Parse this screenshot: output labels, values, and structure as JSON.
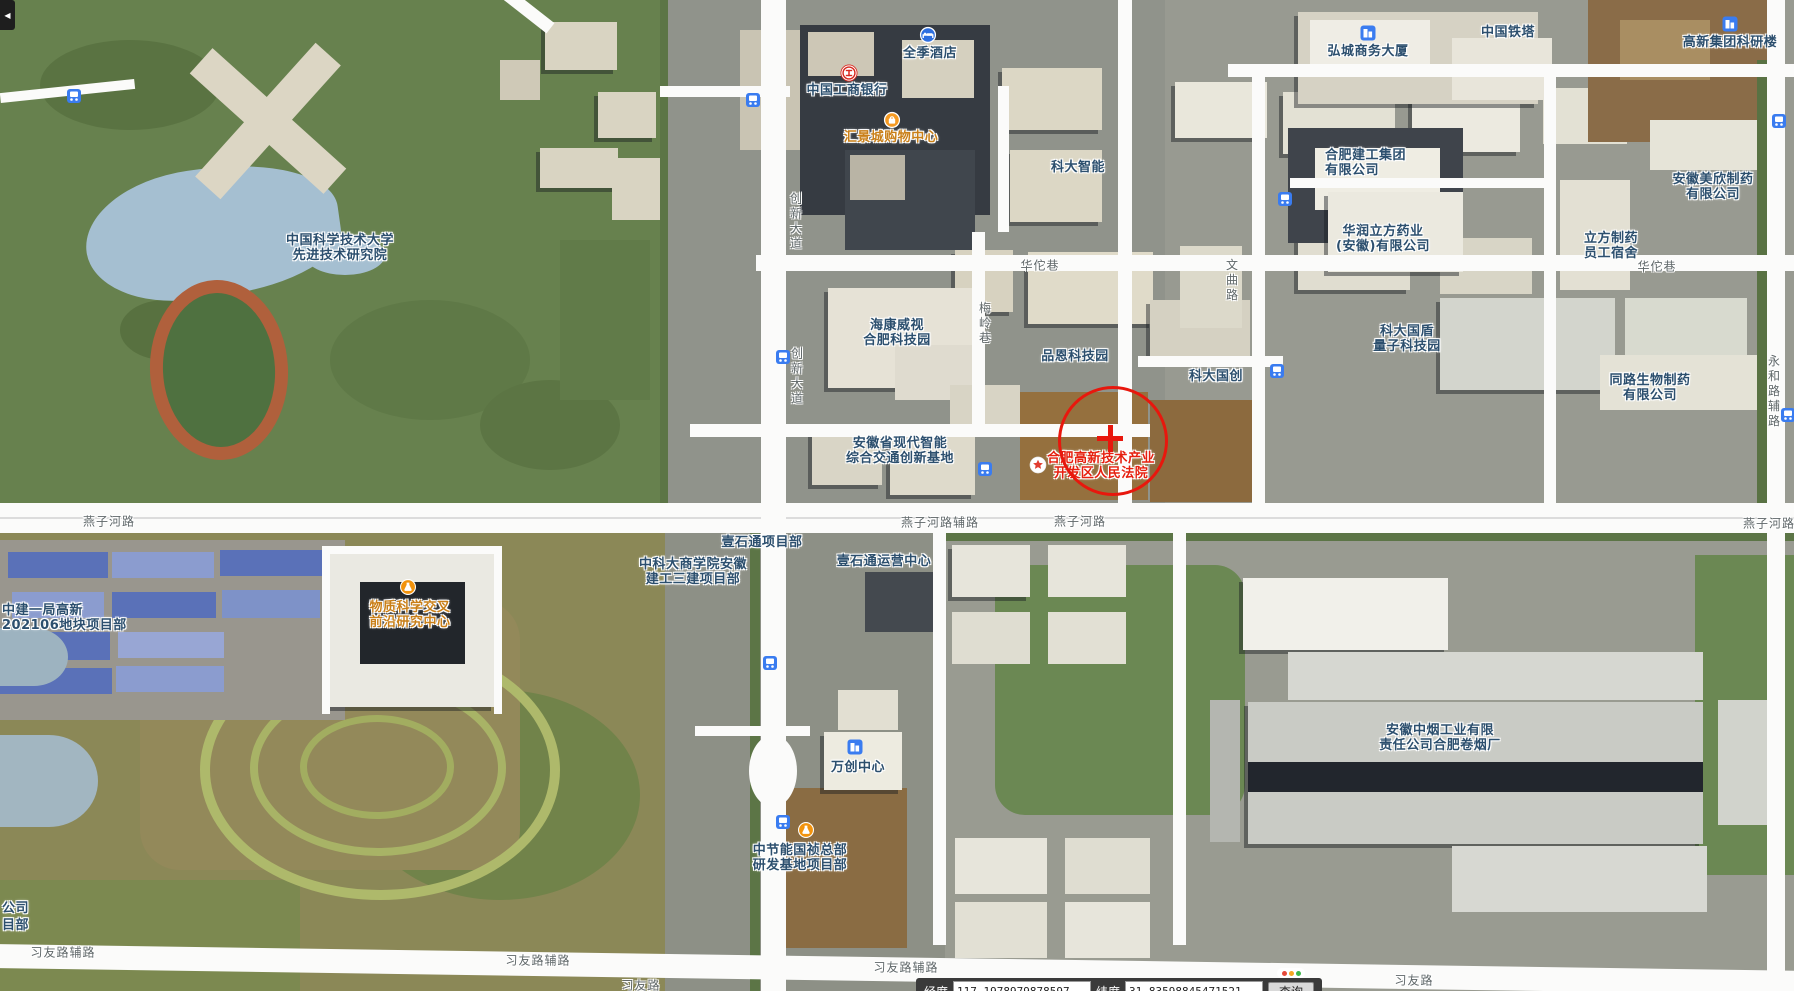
{
  "colors": {
    "poi_blue": "#2c4f6e",
    "poi_red": "#e6200f",
    "poi_orange": "#c97f18",
    "road_label": "#5f6769",
    "circle": "#e8170d"
  },
  "pois": [
    {
      "name": "ustc-advanced-institute",
      "lines": [
        "中国科学技术大学",
        "先进技术研究院"
      ],
      "x": 340,
      "y": 233,
      "color": "blue"
    },
    {
      "name": "quanji-hotel",
      "lines": [
        "全季酒店"
      ],
      "x": 930,
      "y": 46,
      "color": "blue",
      "icon": "hotel",
      "icon_x": 928,
      "icon_y": 35
    },
    {
      "name": "icbc-bank",
      "lines": [
        "中国工商银行"
      ],
      "x": 847,
      "y": 83,
      "color": "blue",
      "icon": "bank",
      "icon_x": 849,
      "icon_y": 73
    },
    {
      "name": "huijingcheng-mall",
      "lines": [
        "汇景城购物中心"
      ],
      "x": 891,
      "y": 130,
      "color": "orange",
      "icon": "shopping",
      "icon_x": 892,
      "icon_y": 120
    },
    {
      "name": "keda-zhineng",
      "lines": [
        "科大智能"
      ],
      "x": 1078,
      "y": 160,
      "color": "blue"
    },
    {
      "name": "hikvision-hefei-park",
      "lines": [
        "海康威视",
        "合肥科技园"
      ],
      "x": 897,
      "y": 318,
      "color": "blue"
    },
    {
      "name": "pinen-tech-park",
      "lines": [
        "品恩科技园"
      ],
      "x": 1075,
      "y": 349,
      "color": "blue"
    },
    {
      "name": "keda-guochuang",
      "lines": [
        "科大国创"
      ],
      "x": 1216,
      "y": 369,
      "color": "blue"
    },
    {
      "name": "anhui-smart-transport-base",
      "lines": [
        "安徽省现代智能",
        "综合交通创新基地"
      ],
      "x": 900,
      "y": 436,
      "color": "blue"
    },
    {
      "name": "hefei-hitech-court",
      "lines": [
        "合肥高新技术产业",
        "开发区人民法院"
      ],
      "x": 1101,
      "y": 451,
      "color": "red",
      "icon": "star",
      "icon_x": 1038,
      "icon_y": 465
    },
    {
      "name": "hongcheng-business-tower",
      "lines": [
        "弘城商务大厦"
      ],
      "x": 1368,
      "y": 44,
      "color": "blue",
      "icon": "building",
      "icon_x": 1368,
      "icon_y": 33
    },
    {
      "name": "china-tower",
      "lines": [
        "中国铁塔"
      ],
      "x": 1508,
      "y": 25,
      "color": "blue"
    },
    {
      "name": "gaoxin-group-research-bldg",
      "lines": [
        "高新集团科研楼"
      ],
      "x": 1730,
      "y": 35,
      "color": "blue",
      "icon": "building",
      "icon_x": 1730,
      "icon_y": 24
    },
    {
      "name": "hefei-construction-group",
      "lines": [
        "合肥建工集团",
        "有限公司"
      ],
      "x": 1325,
      "y": 148,
      "color": "blue",
      "align": "left"
    },
    {
      "name": "huarun-lifang-pharma",
      "lines": [
        "华润立方药业",
        "(安徽)有限公司"
      ],
      "x": 1383,
      "y": 224,
      "color": "blue"
    },
    {
      "name": "anhui-meixin-pharma",
      "lines": [
        "安徽美欣制药",
        "有限公司"
      ],
      "x": 1713,
      "y": 172,
      "color": "blue"
    },
    {
      "name": "lifang-pharma-dorm",
      "lines": [
        "立方制药",
        "员工宿舍"
      ],
      "x": 1611,
      "y": 231,
      "color": "blue"
    },
    {
      "name": "keda-guodun-quantum-park",
      "lines": [
        "科大国盾",
        "量子科技园"
      ],
      "x": 1407,
      "y": 324,
      "color": "blue"
    },
    {
      "name": "tonglu-bio-pharma",
      "lines": [
        "同路生物制药",
        "有限公司"
      ],
      "x": 1650,
      "y": 373,
      "color": "blue"
    },
    {
      "name": "zhongjian-yiju-project",
      "lines": [
        "中建一局高新",
        "202106地块项目部"
      ],
      "x": 2,
      "y": 603,
      "color": "blue",
      "align": "left"
    },
    {
      "name": "matter-science-research-center",
      "lines": [
        "物质科学交叉",
        "前沿研究中心"
      ],
      "x": 410,
      "y": 600,
      "color": "orange",
      "icon": "flask",
      "icon_x": 408,
      "icon_y": 587
    },
    {
      "name": "ustc-business-school-project",
      "lines": [
        "中科大商学院安徽",
        "建工三建项目部"
      ],
      "x": 693,
      "y": 557,
      "color": "blue"
    },
    {
      "name": "yishitong-project-dept",
      "lines": [
        "壹石通项目部"
      ],
      "x": 762,
      "y": 535,
      "color": "blue"
    },
    {
      "name": "yishitong-operation-center",
      "lines": [
        "壹石通运营中心"
      ],
      "x": 884,
      "y": 554,
      "color": "blue"
    },
    {
      "name": "wanchuang-center",
      "lines": [
        "万创中心"
      ],
      "x": 858,
      "y": 760,
      "color": "blue",
      "icon": "building",
      "icon_x": 855,
      "icon_y": 747
    },
    {
      "name": "zhongjieneng-guozhen-hq",
      "lines": [
        "中节能国祯总部",
        "研发基地项目部"
      ],
      "x": 800,
      "y": 843,
      "color": "blue",
      "icon": "flask",
      "icon_x": 806,
      "icon_y": 830
    },
    {
      "name": "anhui-tobacco-hefei-factory",
      "lines": [
        "安徽中烟工业有限",
        "责任公司合肥卷烟厂"
      ],
      "x": 1440,
      "y": 723,
      "color": "blue"
    },
    {
      "name": "clipped-label-company",
      "lines": [
        "公司"
      ],
      "x": 2,
      "y": 901,
      "color": "blue",
      "align": "left"
    },
    {
      "name": "clipped-label-project",
      "lines": [
        "目部"
      ],
      "x": 2,
      "y": 918,
      "color": "blue",
      "align": "left"
    }
  ],
  "road_labels": [
    {
      "name": "yanzihe-road-w",
      "text": "燕子河路",
      "x": 109,
      "y": 521,
      "v": false
    },
    {
      "name": "yanzihe-road-frontage",
      "text": "燕子河路辅路",
      "x": 940,
      "y": 522,
      "v": false
    },
    {
      "name": "yanzihe-road-mid",
      "text": "燕子河路",
      "x": 1080,
      "y": 521,
      "v": false
    },
    {
      "name": "yanzihe-road-e",
      "text": "燕子河路",
      "x": 1769,
      "y": 523,
      "v": false
    },
    {
      "name": "huatuo-lane-w",
      "text": "华佗巷",
      "x": 1040,
      "y": 265,
      "v": false
    },
    {
      "name": "huatuo-lane-e",
      "text": "华佗巷",
      "x": 1657,
      "y": 266,
      "v": false
    },
    {
      "name": "xiyou-road-frontage-w",
      "text": "习友路辅路",
      "x": 63,
      "y": 952,
      "v": false
    },
    {
      "name": "xiyou-road-frontage-mid",
      "text": "习友路辅路",
      "x": 538,
      "y": 960,
      "v": false
    },
    {
      "name": "xiyou-road-s",
      "text": "习友路",
      "x": 641,
      "y": 985,
      "v": false
    },
    {
      "name": "xiyou-road-frontage-e",
      "text": "习友路辅路",
      "x": 906,
      "y": 967,
      "v": false
    },
    {
      "name": "xiyou-road-e",
      "text": "习友路",
      "x": 1414,
      "y": 980,
      "v": false
    },
    {
      "name": "chuangxin-avenue-n",
      "text": "创新大道",
      "x": 796,
      "y": 222,
      "v": true
    },
    {
      "name": "chuangxin-avenue-mid",
      "text": "创新大道",
      "x": 797,
      "y": 377,
      "v": true
    },
    {
      "name": "meiling-lane",
      "text": "梅岭巷",
      "x": 985,
      "y": 324,
      "v": true
    },
    {
      "name": "wenqu-road",
      "text": "文曲路",
      "x": 1232,
      "y": 281,
      "v": true
    },
    {
      "name": "yonghe-road-frontage",
      "text": "永和路辅路",
      "x": 1774,
      "y": 392,
      "v": true
    }
  ],
  "bus_stops": [
    {
      "x": 74,
      "y": 96
    },
    {
      "x": 753,
      "y": 100
    },
    {
      "x": 1285,
      "y": 199
    },
    {
      "x": 783,
      "y": 357
    },
    {
      "x": 1277,
      "y": 371
    },
    {
      "x": 985,
      "y": 469
    },
    {
      "x": 770,
      "y": 663
    },
    {
      "x": 783,
      "y": 822
    },
    {
      "x": 1779,
      "y": 121
    },
    {
      "x": 1788,
      "y": 415
    }
  ],
  "annotation": {
    "circle_x": 1110,
    "circle_y": 438,
    "radius": 52
  },
  "collapse_button": {
    "glyph": "◀"
  },
  "status_dots": [
    "#e5493a",
    "#f5a623",
    "#3cb54a"
  ],
  "coord_bar": {
    "lng_label": "经度",
    "lng_value": "117.1978979878597",
    "lat_label": "纬度",
    "lat_value": "31.83598845471521",
    "query_label": "查询"
  }
}
